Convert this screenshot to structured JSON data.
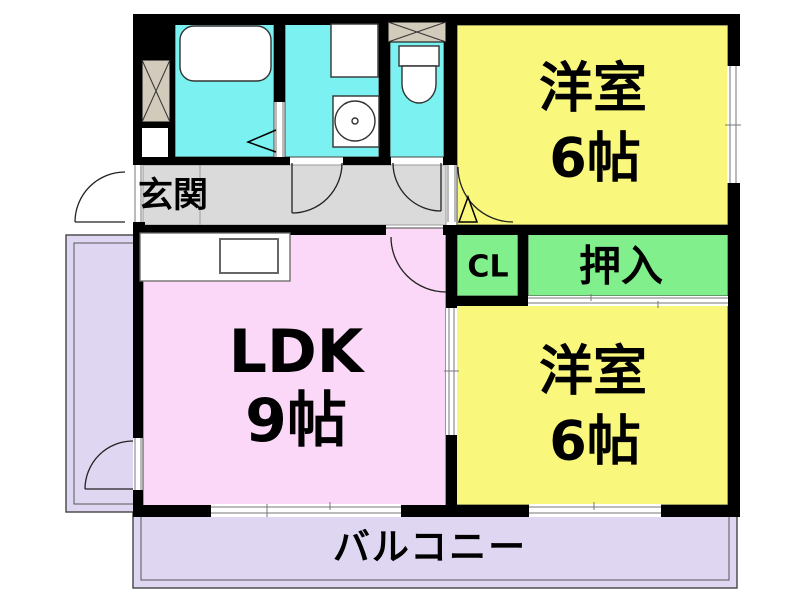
{
  "plan_title": "2DK apartment floor plan",
  "colors": {
    "wall": "#000000",
    "bedroom_fill": "#faf77d",
    "ldk_fill": "#fbd8f7",
    "closet_fill": "#80ef8c",
    "wet_area_fill": "#7bf1f1",
    "corridor_fill": "#dadada",
    "balcony_fill": "#dfd6f2",
    "pipe_space_fill": "#d2cabb",
    "room_border": "#444444"
  },
  "rooms": {
    "bedroom_top": {
      "name": "洋室",
      "size": "6帖"
    },
    "bedroom_bottom": {
      "name": "洋室",
      "size": "6帖"
    },
    "ldk": {
      "name": "LDK",
      "size": "9帖"
    },
    "closet": {
      "label": "CL"
    },
    "oshiire": {
      "label": "押入"
    },
    "entrance": {
      "label": "玄関"
    },
    "balcony": {
      "label": "バルコニー"
    }
  },
  "fixtures": {
    "bathtub": "bathtub",
    "washing_machine_space": "washing-machine-space",
    "washbasin": "washbasin",
    "toilet": "toilet",
    "kitchen_counter": "kitchen-counter",
    "pipe_space": "pipe-space-hatch"
  }
}
